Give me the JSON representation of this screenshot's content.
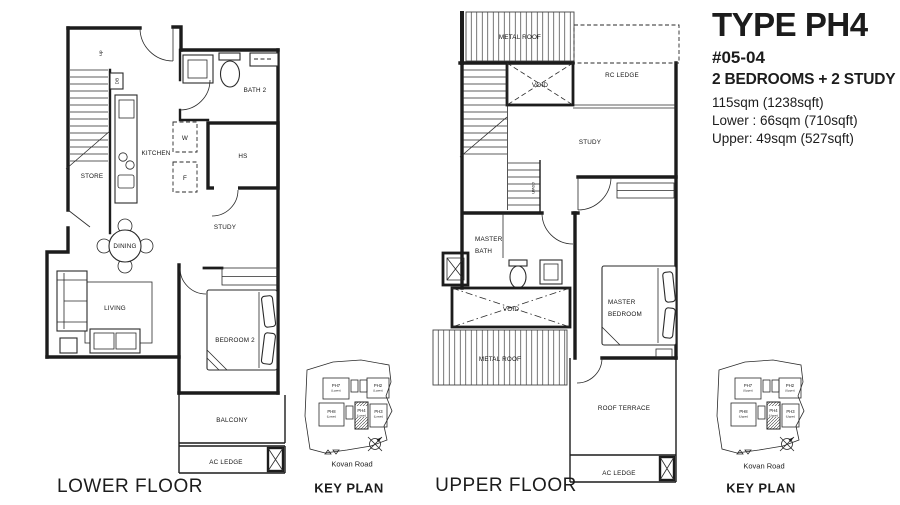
{
  "title_block": {
    "type_label": "TYPE PH4",
    "unit_number": "#05-04",
    "configuration": "2 BEDROOMS + 2 STUDY",
    "area_total": "115sqm (1238sqft)",
    "area_lower": "Lower : 66sqm (710sqft)",
    "area_upper": "Upper: 49sqm (527sqft)"
  },
  "lower_floor": {
    "caption": "LOWER FLOOR",
    "labels": {
      "store": "STORE",
      "kitchen": "KITCHEN",
      "bath2": "BATH 2",
      "hs": "HS",
      "study": "STUDY",
      "dining": "DINING",
      "living": "LIVING",
      "bedroom2": "BEDROOM 2",
      "balcony": "BALCONY",
      "ac_ledge": "AC LEDGE",
      "stairs_up": "up",
      "db": "DB",
      "washer": "W",
      "fridge": "F"
    }
  },
  "upper_floor": {
    "caption": "UPPER FLOOR",
    "labels": {
      "metal_roof_top": "METAL ROOF",
      "rc_ledge": "RC LEDGE",
      "void_upper": "VOID",
      "study": "STUDY",
      "stairs_down": "down",
      "master_bath_line1": "MASTER",
      "master_bath_line2": "BATH",
      "void_lower": "VOID",
      "master_bedroom_line1": "MASTER",
      "master_bedroom_line2": "BEDROOM",
      "metal_roof_bottom": "METAL ROOF",
      "roof_terrace": "ROOF TERRACE",
      "ac_ledge": "AC LEDGE"
    }
  },
  "key_plan_lower": {
    "caption": "KEY PLAN",
    "road": "Kovan Road",
    "buildings": [
      {
        "name": "PH7",
        "sub": "(Lower)"
      },
      {
        "name": "PH2",
        "sub": "(Lower)"
      },
      {
        "name": "PH8",
        "sub": "(Lower)"
      },
      {
        "name": "PH4",
        "sub": "(Lower)"
      },
      {
        "name": "PH3",
        "sub": "(Lower)"
      }
    ]
  },
  "key_plan_upper": {
    "caption": "KEY PLAN",
    "road": "Kovan Road",
    "buildings": [
      {
        "name": "PH7",
        "sub": "(Upper)"
      },
      {
        "name": "PH2",
        "sub": "(Upper)"
      },
      {
        "name": "PH8",
        "sub": "(Upper)"
      },
      {
        "name": "PH4",
        "sub": "(Upper)"
      },
      {
        "name": "PH3",
        "sub": "(Upper)"
      }
    ]
  },
  "colors": {
    "ink": "#1c1c1c",
    "background": "#ffffff"
  }
}
